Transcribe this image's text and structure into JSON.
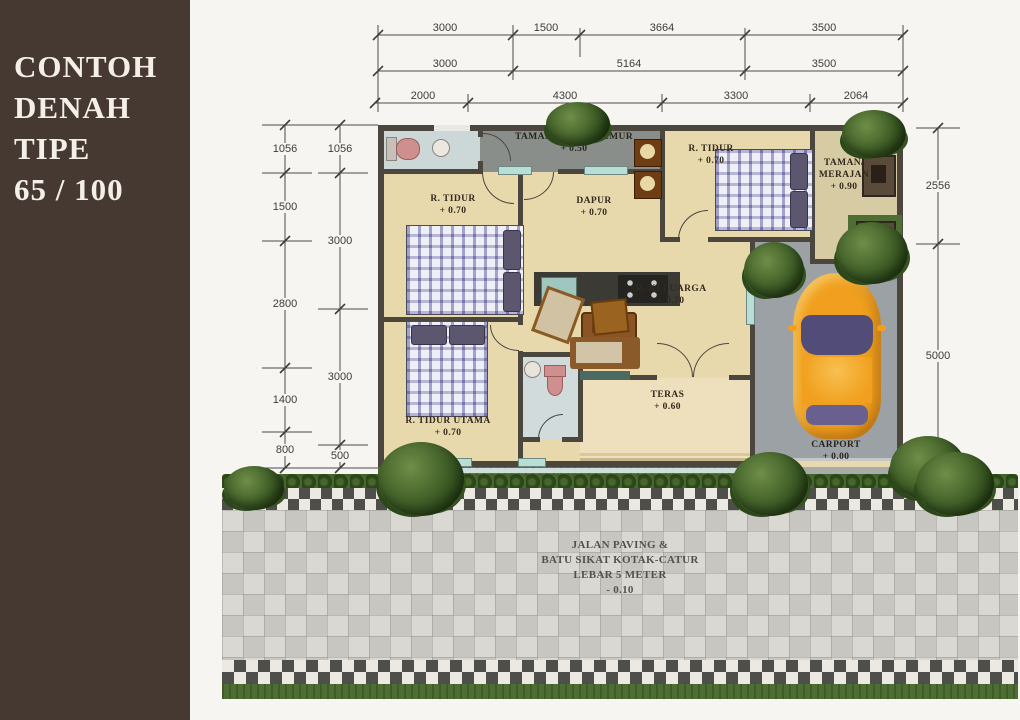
{
  "sidebar": {
    "line1": "CONTOH",
    "line2": "DENAH",
    "line3": "TIPE",
    "line4": "65 / 100"
  },
  "dims": {
    "top1": [
      "3000",
      "1500",
      "3664",
      "3500"
    ],
    "top2": [
      "3000",
      "5164",
      "3500"
    ],
    "top3": [
      "2000",
      "4300",
      "3300",
      "2064"
    ],
    "left_outer": [
      "1056",
      "1500",
      "2800",
      "1400",
      "800"
    ],
    "left_inner": [
      "1056",
      "3000",
      "3000",
      "500"
    ],
    "right": [
      "2556",
      "5000"
    ]
  },
  "rooms": {
    "taman_jemur": {
      "name": "TAMAN, RUANG JEMUR",
      "level": "+ 0.50"
    },
    "tidur1": {
      "name": "R. TIDUR",
      "level": "+ 0.70"
    },
    "dapur": {
      "name": "DAPUR",
      "level": "+ 0.70"
    },
    "tidur2": {
      "name": "R. TIDUR",
      "level": "+ 0.70"
    },
    "taman_merajan": {
      "name": "TAMAN/",
      "name2": "MERAJAN",
      "level": "+ 0.90"
    },
    "keluarga": {
      "name": "R. KELUARGA",
      "level": "+ 0.70"
    },
    "tidur_utama": {
      "name": "R. TIDUR UTAMA",
      "level": "+ 0.70"
    },
    "teras": {
      "name": "TERAS",
      "level": "+ 0.60"
    },
    "carport": {
      "name": "CARPORT",
      "level": "+ 0.00"
    }
  },
  "paving": {
    "line1": "JALAN PAVING &",
    "line2": "BATU SIKAT KOTAK-CATUR",
    "line3": "LEBAR 5 METER",
    "line4": "- 0.10"
  },
  "colors": {
    "sidebar_bg": "#453931",
    "wall": "#4b463e",
    "floor": "#e8d9ad",
    "taman_floor": "#8a8e8a",
    "carport_floor": "#9ba1a5",
    "paving": "#d9d8d3",
    "checker_dark": "#4e4e4a",
    "grass": "#5d7d3b",
    "car": "#f0a01e",
    "window_teal": "#b9ded6"
  }
}
